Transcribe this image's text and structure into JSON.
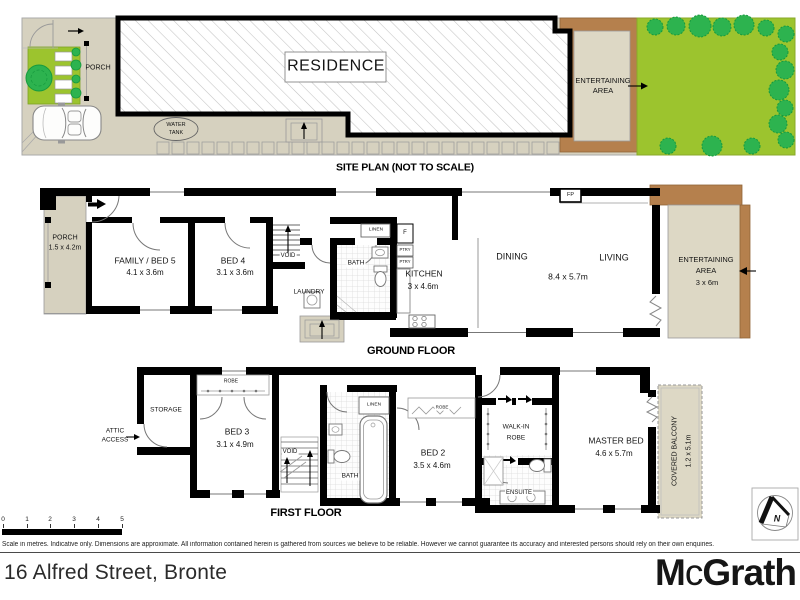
{
  "site_plan": {
    "porch": "PORCH",
    "residence": "RESIDENCE",
    "water_tank_line1": "WATER",
    "water_tank_line2": "TANK",
    "entertaining_line1": "ENTERTAINING",
    "entertaining_line2": "AREA",
    "caption": "SITE PLAN (NOT TO SCALE)"
  },
  "ground_floor": {
    "caption": "GROUND FLOOR",
    "porch": "PORCH",
    "porch_dims": "1.5 x 4.2m",
    "family_bed5": "FAMILY / BED 5",
    "family_bed5_dims": "4.1 x 3.6m",
    "bed4": "BED 4",
    "bed4_dims": "3.1 x 3.6m",
    "void": "VOID",
    "laundry": "LAUNDRY",
    "bath": "BATH",
    "linen": "LINEN",
    "fridge": "F",
    "pantry1": "PTRY",
    "pantry2": "PTRY",
    "kitchen": "KITCHEN",
    "kitchen_dims": "3 x 4.6m",
    "dining": "DINING",
    "living": "LIVING",
    "living_dining_dims": "8.4 x 5.7m",
    "fireplace": "FP",
    "entertaining_line1": "ENTERTAINING",
    "entertaining_line2": "AREA",
    "entertaining_dims": "3 x 6m"
  },
  "first_floor": {
    "caption": "FIRST FLOOR",
    "attic_line1": "ATTIC",
    "attic_line2": "ACCESS",
    "storage": "STORAGE",
    "robe_bed3": "ROBE",
    "bed3": "BED 3",
    "bed3_dims": "3.1 x 4.9m",
    "void": "VOID",
    "linen": "LINEN",
    "bath": "BATH",
    "robe_bed2": "ROBE",
    "bed2": "BED 2",
    "bed2_dims": "3.5 x 4.6m",
    "walk_in_line1": "WALK-IN",
    "walk_in_line2": "ROBE",
    "ensuite": "ENSUITE",
    "master_bed": "MASTER BED",
    "master_bed_dims": "4.6 x 5.7m",
    "balcony": "COVERED BALCONY",
    "balcony_dims": "1.2 x 5.1m",
    "north": "N"
  },
  "footer": {
    "scale_numbers": [
      "0",
      "1",
      "2",
      "3",
      "4",
      "5"
    ],
    "disclaimer": "Scale in metres. Indicative only. Dimensions are approximate. All information contained herein is gathered from sources we believe to be reliable. However we cannot guarantee its accuracy and interested persons should rely on their own enquiries.",
    "address": "16 Alfred Street, Bronte",
    "brand_m": "M",
    "brand_c": "c",
    "brand_grath": "Grath"
  },
  "colors": {
    "paving_beige": "#d6d1bf",
    "inner_beige": "#ddd8c5",
    "deck_brown": "#b5804d",
    "lawn_green": "#9cc42e",
    "tree_green": "#2db34f",
    "wall_black": "#000000"
  }
}
